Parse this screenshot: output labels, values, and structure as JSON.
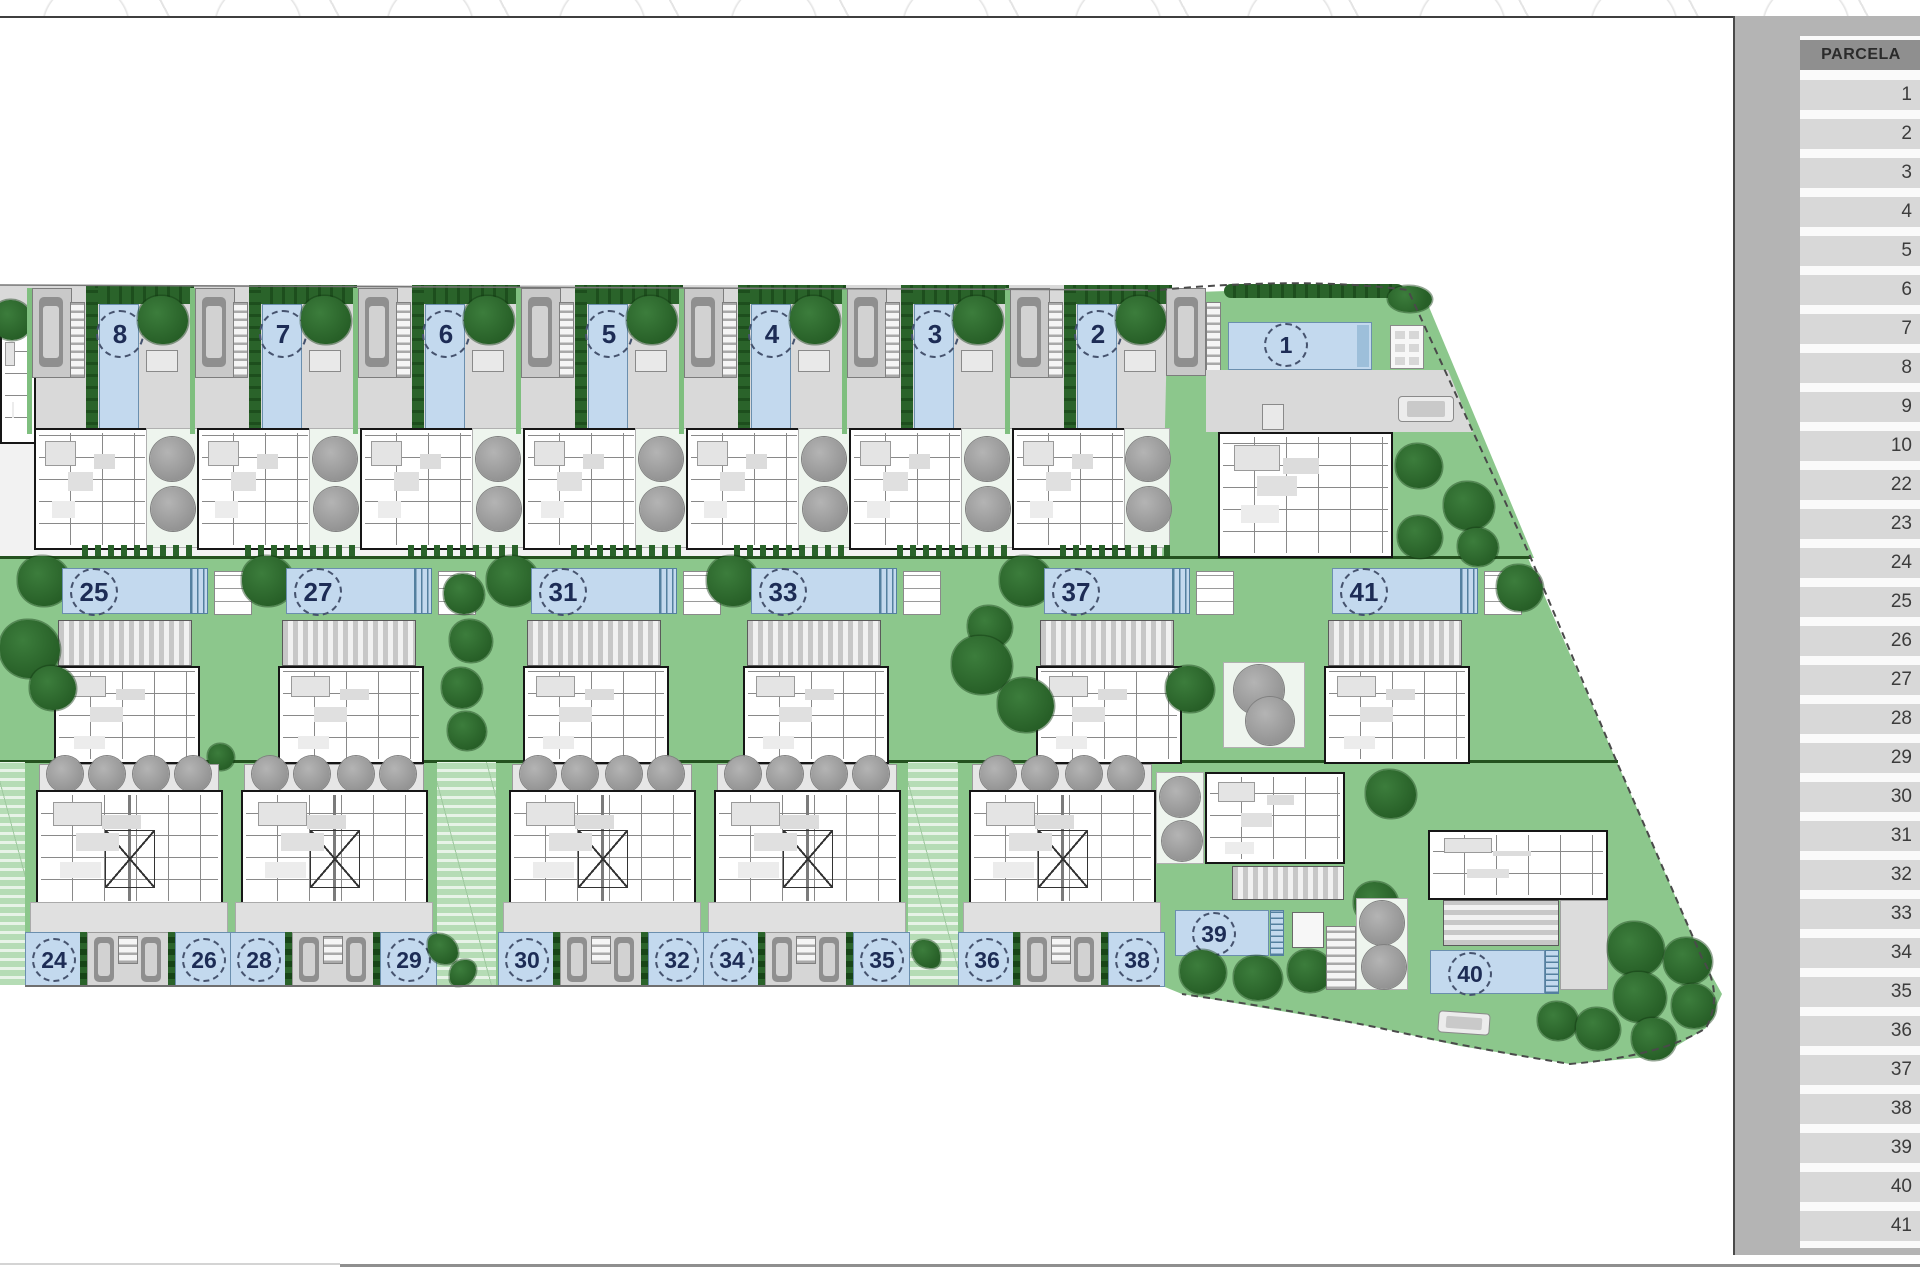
{
  "sidebar": {
    "header": "PARCELA",
    "rows": [
      "1",
      "2",
      "3",
      "4",
      "5",
      "6",
      "7",
      "8",
      "9",
      "10",
      "22",
      "23",
      "24",
      "25",
      "26",
      "27",
      "28",
      "29",
      "30",
      "31",
      "32",
      "33",
      "34",
      "35",
      "36",
      "37",
      "38",
      "39",
      "40",
      "41"
    ]
  },
  "parcels": {
    "top": [
      "8",
      "7",
      "6",
      "5",
      "4",
      "3",
      "2",
      "1"
    ],
    "middle": [
      "25",
      "27",
      "31",
      "33",
      "37",
      "41"
    ],
    "bottom": [
      "24",
      "26",
      "28",
      "29",
      "30",
      "32",
      "34",
      "35",
      "36",
      "38"
    ],
    "detached": [
      "39",
      "40"
    ]
  },
  "colors": {
    "lawn": "#8cc78c",
    "dark_green": "#2a632a",
    "pool": "#c3d9ee",
    "pool_border": "#6b8fae",
    "hardscape": "#d9d9d9",
    "sidebar_bg": "#b4b4b4",
    "cell_bg": "#d8d8d8",
    "header_bg": "#8f8f8f"
  }
}
